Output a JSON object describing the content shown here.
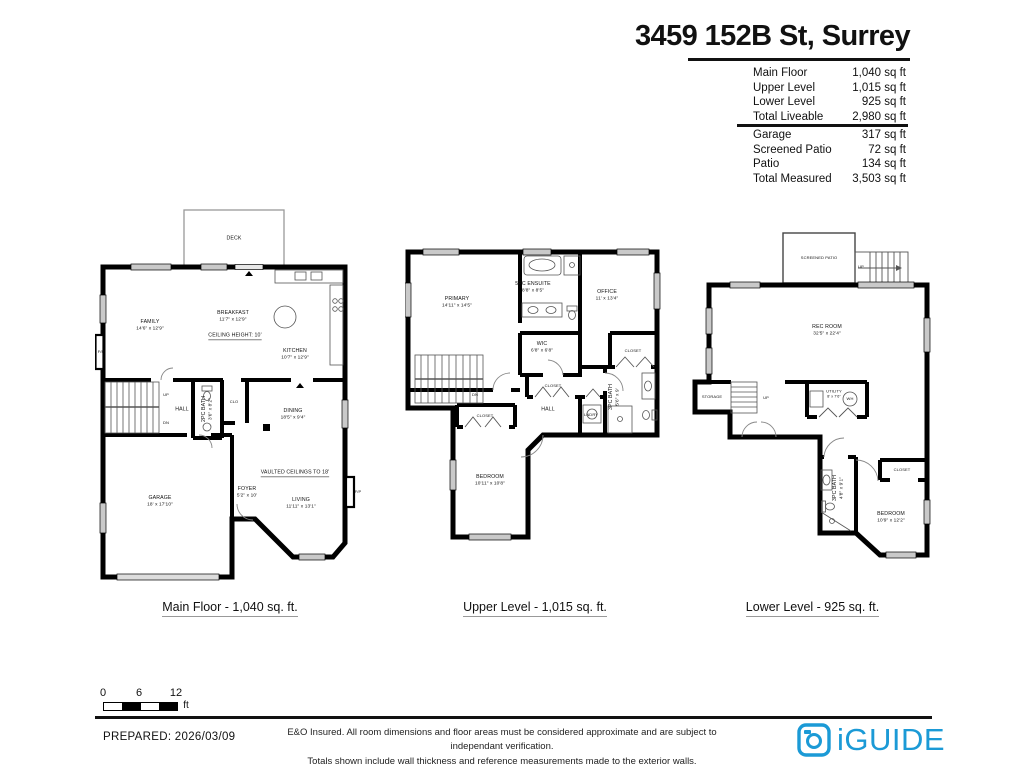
{
  "title": "3459 152B St, Surrey",
  "accent_color": "#1b9ad6",
  "summary": {
    "liveable": [
      {
        "label": "Main Floor",
        "value": "1,040 sq ft"
      },
      {
        "label": "Upper Level",
        "value": "1,015 sq ft"
      },
      {
        "label": "Lower Level",
        "value": "925 sq ft"
      },
      {
        "label": "Total Liveable",
        "value": "2,980 sq ft"
      }
    ],
    "other": [
      {
        "label": "Garage",
        "value": "317 sq ft"
      },
      {
        "label": "Screened Patio",
        "value": "72 sq ft"
      },
      {
        "label": "Patio",
        "value": "134 sq ft"
      },
      {
        "label": "Total Measured",
        "value": "3,503 sq ft"
      }
    ]
  },
  "plans": {
    "main": {
      "caption": "Main Floor - 1,040 sq. ft.",
      "rooms": {
        "deck": {
          "name": "DECK"
        },
        "family": {
          "name": "FAMILY",
          "dims": "14'6\" x 12'9\""
        },
        "breakfast": {
          "name": "BREAKFAST",
          "dims": "11'7\" x 12'9\""
        },
        "ceiling_note": {
          "name": "CEILING HEIGHT: 10'"
        },
        "kitchen": {
          "name": "KITCHEN",
          "dims": "10'7\" x 12'9\""
        },
        "up": {
          "name": "UP"
        },
        "dn": {
          "name": "DN"
        },
        "hall": {
          "name": "HALL"
        },
        "bath2pc": {
          "name": "2PC BATH",
          "dims": "3'6\" x 8'2\""
        },
        "clo": {
          "name": "CLO"
        },
        "dining": {
          "name": "DINING",
          "dims": "18'5\" x 9'4\""
        },
        "vaulted_note": {
          "name": "VAULTED CEILINGS TO 18'"
        },
        "foyer": {
          "name": "FOYER",
          "dims": "5'2\" x 10'"
        },
        "living": {
          "name": "LIVING",
          "dims": "11'11\" x 13'1\""
        },
        "garage": {
          "name": "GARAGE",
          "dims": "18' x 17'10\""
        },
        "fp_left": {
          "name": "F/P"
        },
        "fp_right": {
          "name": "F/P"
        }
      }
    },
    "upper": {
      "caption": "Upper Level - 1,015 sq. ft.",
      "rooms": {
        "primary": {
          "name": "PRIMARY",
          "dims": "14'11\" x 14'5\""
        },
        "ensuite": {
          "name": "5PC ENSUITE",
          "dims": "8'8\" x 8'5\""
        },
        "office": {
          "name": "OFFICE",
          "dims": "11' x 13'4\""
        },
        "wic": {
          "name": "WIC",
          "dims": "6'8\" x 6'8\""
        },
        "closet_office": {
          "name": "CLOSET"
        },
        "closet_hall": {
          "name": "CLOSET"
        },
        "bath3pc": {
          "name": "3PC BATH",
          "dims": "5'6\" x 9'"
        },
        "lndry": {
          "name": "LNDRY"
        },
        "hall": {
          "name": "HALL"
        },
        "dn": {
          "name": "DN"
        },
        "closet_bedroom": {
          "name": "CLOSET"
        },
        "bedroom": {
          "name": "BEDROOM",
          "dims": "10'11\" x 10'8\""
        }
      }
    },
    "lower": {
      "caption": "Lower Level - 925 sq. ft.",
      "rooms": {
        "screened_patio": {
          "name": "SCREENED PATIO"
        },
        "up_patio": {
          "name": "UP"
        },
        "rec_room": {
          "name": "REC ROOM",
          "dims": "32'5\" x 22'4\""
        },
        "storage": {
          "name": "STORAGE"
        },
        "up": {
          "name": "UP"
        },
        "utility": {
          "name": "UTILITY",
          "dims": "8' x 7'6\""
        },
        "wh": {
          "name": "WH"
        },
        "bath3pc": {
          "name": "3PC BATH",
          "dims": "4'8\" x 9'1\""
        },
        "closet": {
          "name": "CLOSET"
        },
        "bedroom": {
          "name": "BEDROOM",
          "dims": "10'9\" x 12'2\""
        }
      }
    }
  },
  "scale_bar": {
    "labels": [
      "0",
      "6",
      "12"
    ],
    "unit": "ft"
  },
  "footer": {
    "prepared": "PREPARED: 2026/03/09",
    "disclaimer_line1": "E&O Insured. All room dimensions and floor areas must be considered approximate and are subject to independant verification.",
    "disclaimer_line2": "Totals shown include wall thickness and reference measurements made to the exterior walls.",
    "brand": "iGUIDE"
  }
}
